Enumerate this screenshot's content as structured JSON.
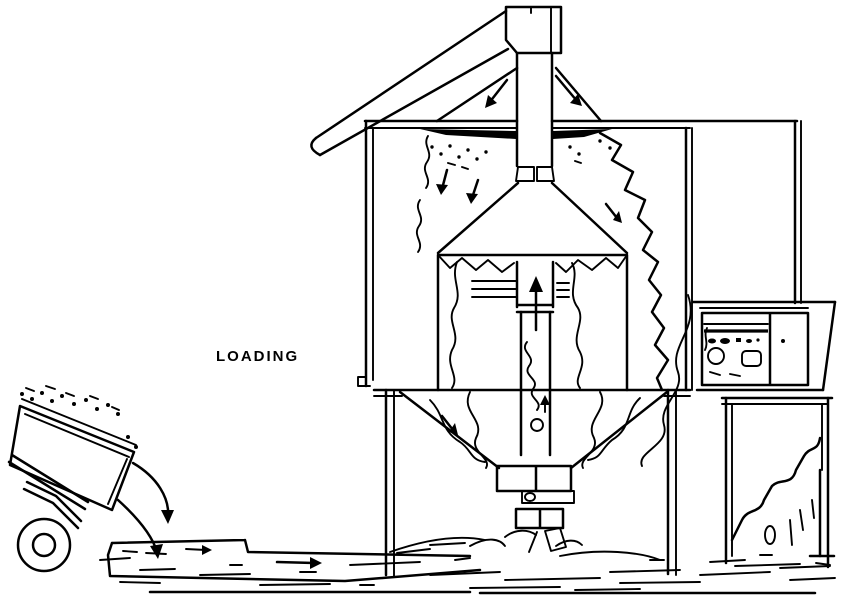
{
  "diagram": {
    "labels": {
      "loading": "LOADING"
    },
    "colors": {
      "line": "#000000",
      "background": "#ffffff"
    }
  }
}
